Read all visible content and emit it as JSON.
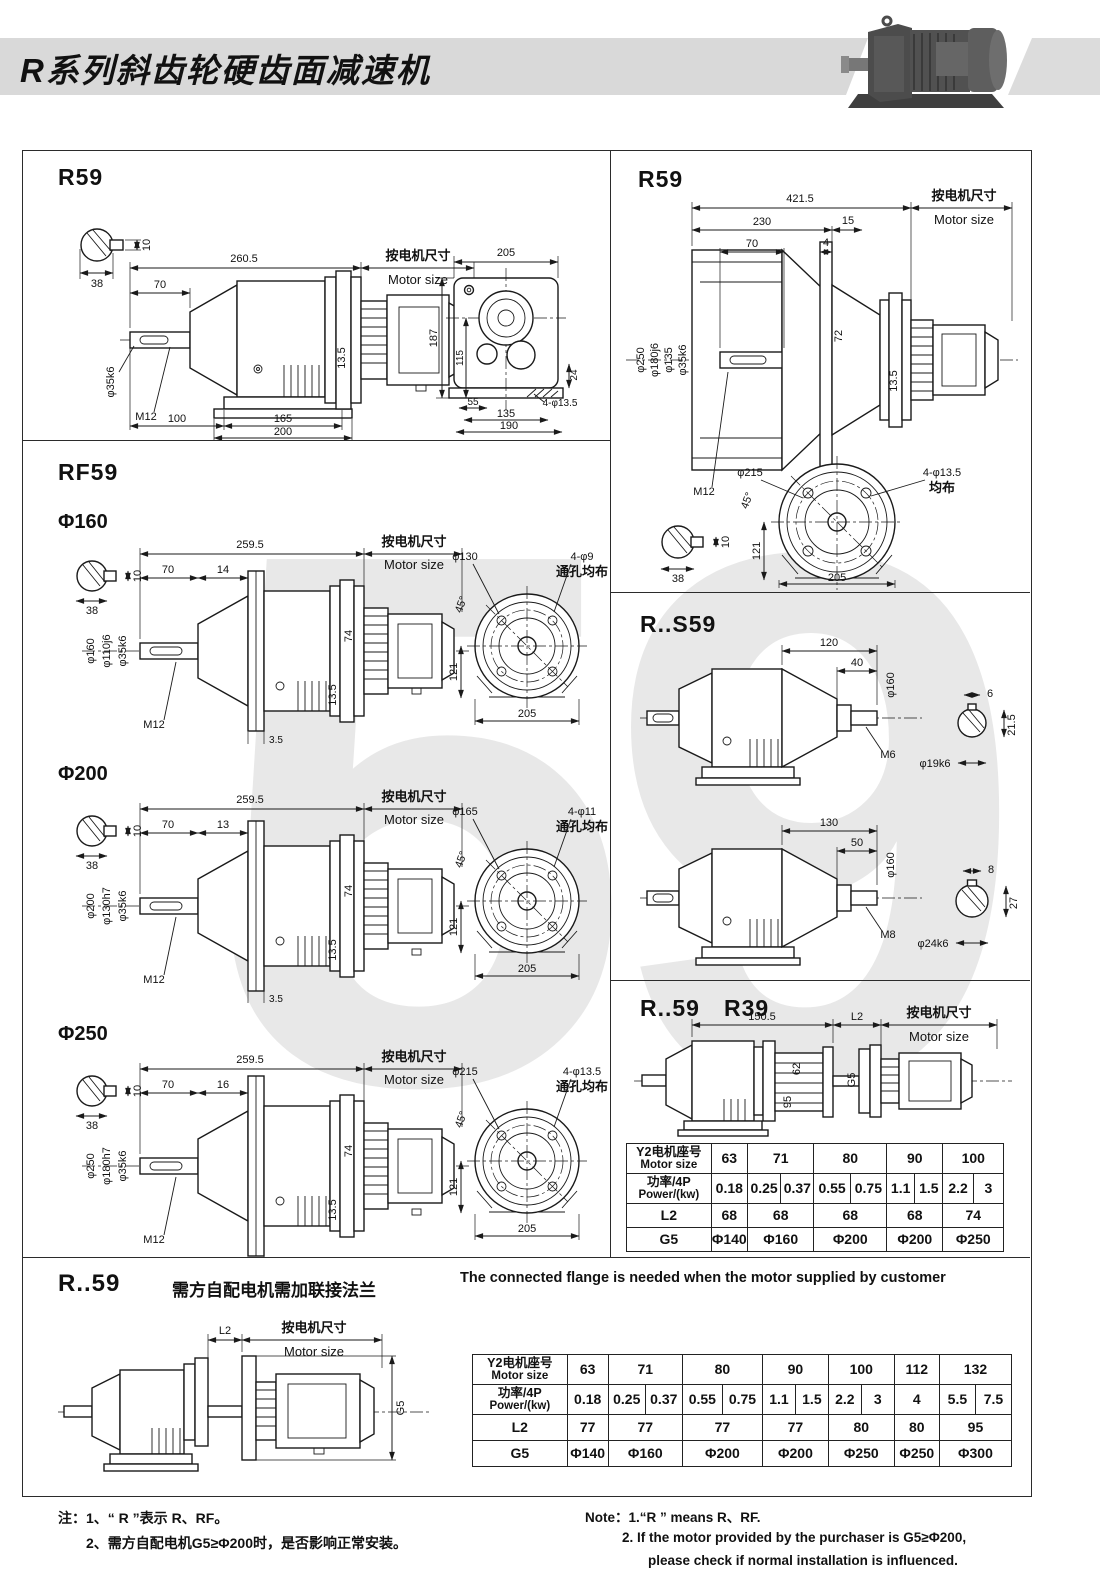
{
  "header": {
    "title": "R系列斜齿轮硬齿面减速机"
  },
  "watermark": "59",
  "common": {
    "motor_zh": "按电机尺寸",
    "motor_en": "Motor size",
    "junbu": "均布",
    "tkjb": "通孔均布",
    "deg45": "45°",
    "v121": "121",
    "v205": "205",
    "v38": "38",
    "v10": "10"
  },
  "p1": {
    "title": "R59",
    "total": "260.5",
    "a70": "70",
    "t135": "13.5",
    "shaft_dia": "φ35k6",
    "m12": "M12",
    "b100": "100",
    "b165": "165",
    "b200": "200",
    "w205": "205",
    "h187": "187",
    "h115": "115",
    "h24": "24",
    "b55": "55",
    "b135": "135",
    "b190": "190",
    "holes": "4-φ13.5"
  },
  "p2": {
    "title": "R59",
    "total": "421.5",
    "a230": "230",
    "a15": "15",
    "a70": "70",
    "a4": "4",
    "d250": "φ250",
    "d180": "φ180j6",
    "d135": "φ135",
    "d35": "φ35k6",
    "h72": "72",
    "t135": "13.5",
    "m12": "M12",
    "fd": "φ215",
    "holes": "4-φ13.5"
  },
  "p3": {
    "title": "RF59",
    "s1": {
      "label": "Φ160",
      "total": "259.5",
      "a70": "70",
      "a2": "14",
      "h74": "74",
      "t135": "13.5",
      "dA": "φ160",
      "dB": "φ110j6",
      "dC": "φ35k6",
      "m12": "M12",
      "gap": "3.5",
      "fd": "φ130",
      "holes": "4-φ9"
    },
    "s2": {
      "label": "Φ200",
      "total": "259.5",
      "a70": "70",
      "a2": "13",
      "h74": "74",
      "t135": "13.5",
      "dA": "φ200",
      "dB": "φ130h7",
      "dC": "φ35k6",
      "m12": "M12",
      "gap": "3.5",
      "fd": "φ165",
      "holes": "4-φ11"
    },
    "s3": {
      "label": "Φ250",
      "total": "259.5",
      "a70": "70",
      "a2": "16",
      "h74": "74",
      "t135": "13.5",
      "dA": "φ250",
      "dB": "φ180h7",
      "dC": "φ35k6",
      "m12": "M12",
      "gap": "4",
      "fd": "φ215",
      "holes": "4-φ13.5"
    }
  },
  "p4": {
    "title": "R..S59",
    "v1": {
      "len": "120",
      "stub": "40",
      "dia": "φ160",
      "thread": "M6",
      "key": "6",
      "shaft": "φ19k6",
      "depth": "21.5"
    },
    "v2": {
      "len": "130",
      "stub": "50",
      "dia": "φ160",
      "thread": "M8",
      "key": "8",
      "shaft": "φ24k6",
      "depth": "27"
    }
  },
  "p5": {
    "title1": "R..59",
    "title2": "R39",
    "len": "150.5",
    "l2": "L2",
    "h62": "62",
    "h95": "95",
    "g5": "G5"
  },
  "p6": {
    "title": "R..59",
    "sub_zh": "需方自配电机需加联接法兰",
    "sub_en": "The connected flange is needed when the motor supplied by customer",
    "l2": "L2",
    "g5": "G5"
  },
  "table1": {
    "size_zh": "Y2电机座号",
    "size_en": "Motor size",
    "power_zh": "功率/4P",
    "power_en": "Power/(kw)",
    "l2_label": "L2",
    "g5_label": "G5",
    "sizes": [
      "63",
      "71",
      "80",
      "90",
      "100"
    ],
    "powers": [
      "0.18",
      "0.25",
      "0.37",
      "0.55",
      "0.75",
      "1.1",
      "1.5",
      "2.2",
      "3"
    ],
    "l2": [
      "68",
      "68",
      "68",
      "68",
      "74"
    ],
    "g5": [
      "Φ140",
      "Φ160",
      "Φ200",
      "Φ200",
      "Φ250"
    ]
  },
  "table2": {
    "size_zh": "Y2电机座号",
    "size_en": "Motor size",
    "power_zh": "功率/4P",
    "power_en": "Power/(kw)",
    "l2_label": "L2",
    "g5_label": "G5",
    "sizes": [
      "63",
      "71",
      "80",
      "90",
      "100",
      "112",
      "132"
    ],
    "powers": [
      "0.18",
      "0.25",
      "0.37",
      "0.55",
      "0.75",
      "1.1",
      "1.5",
      "2.2",
      "3",
      "4",
      "5.5",
      "7.5"
    ],
    "l2": [
      "77",
      "77",
      "77",
      "77",
      "80",
      "80",
      "95"
    ],
    "g5": [
      "Φ140",
      "Φ160",
      "Φ200",
      "Φ200",
      "Φ250",
      "Φ250",
      "Φ300"
    ]
  },
  "notes": {
    "zh1": "注：1、“ R ”表示 R、RF。",
    "zh2": "2、需方自配电机G5≥Φ200时，是否影响正常安装。",
    "en1": "Note：1.“R ” means R、RF.",
    "en2": "2. If the motor provided by the purchaser is G5≥Φ200,",
    "en3": "please check if normal installation is influenced."
  }
}
